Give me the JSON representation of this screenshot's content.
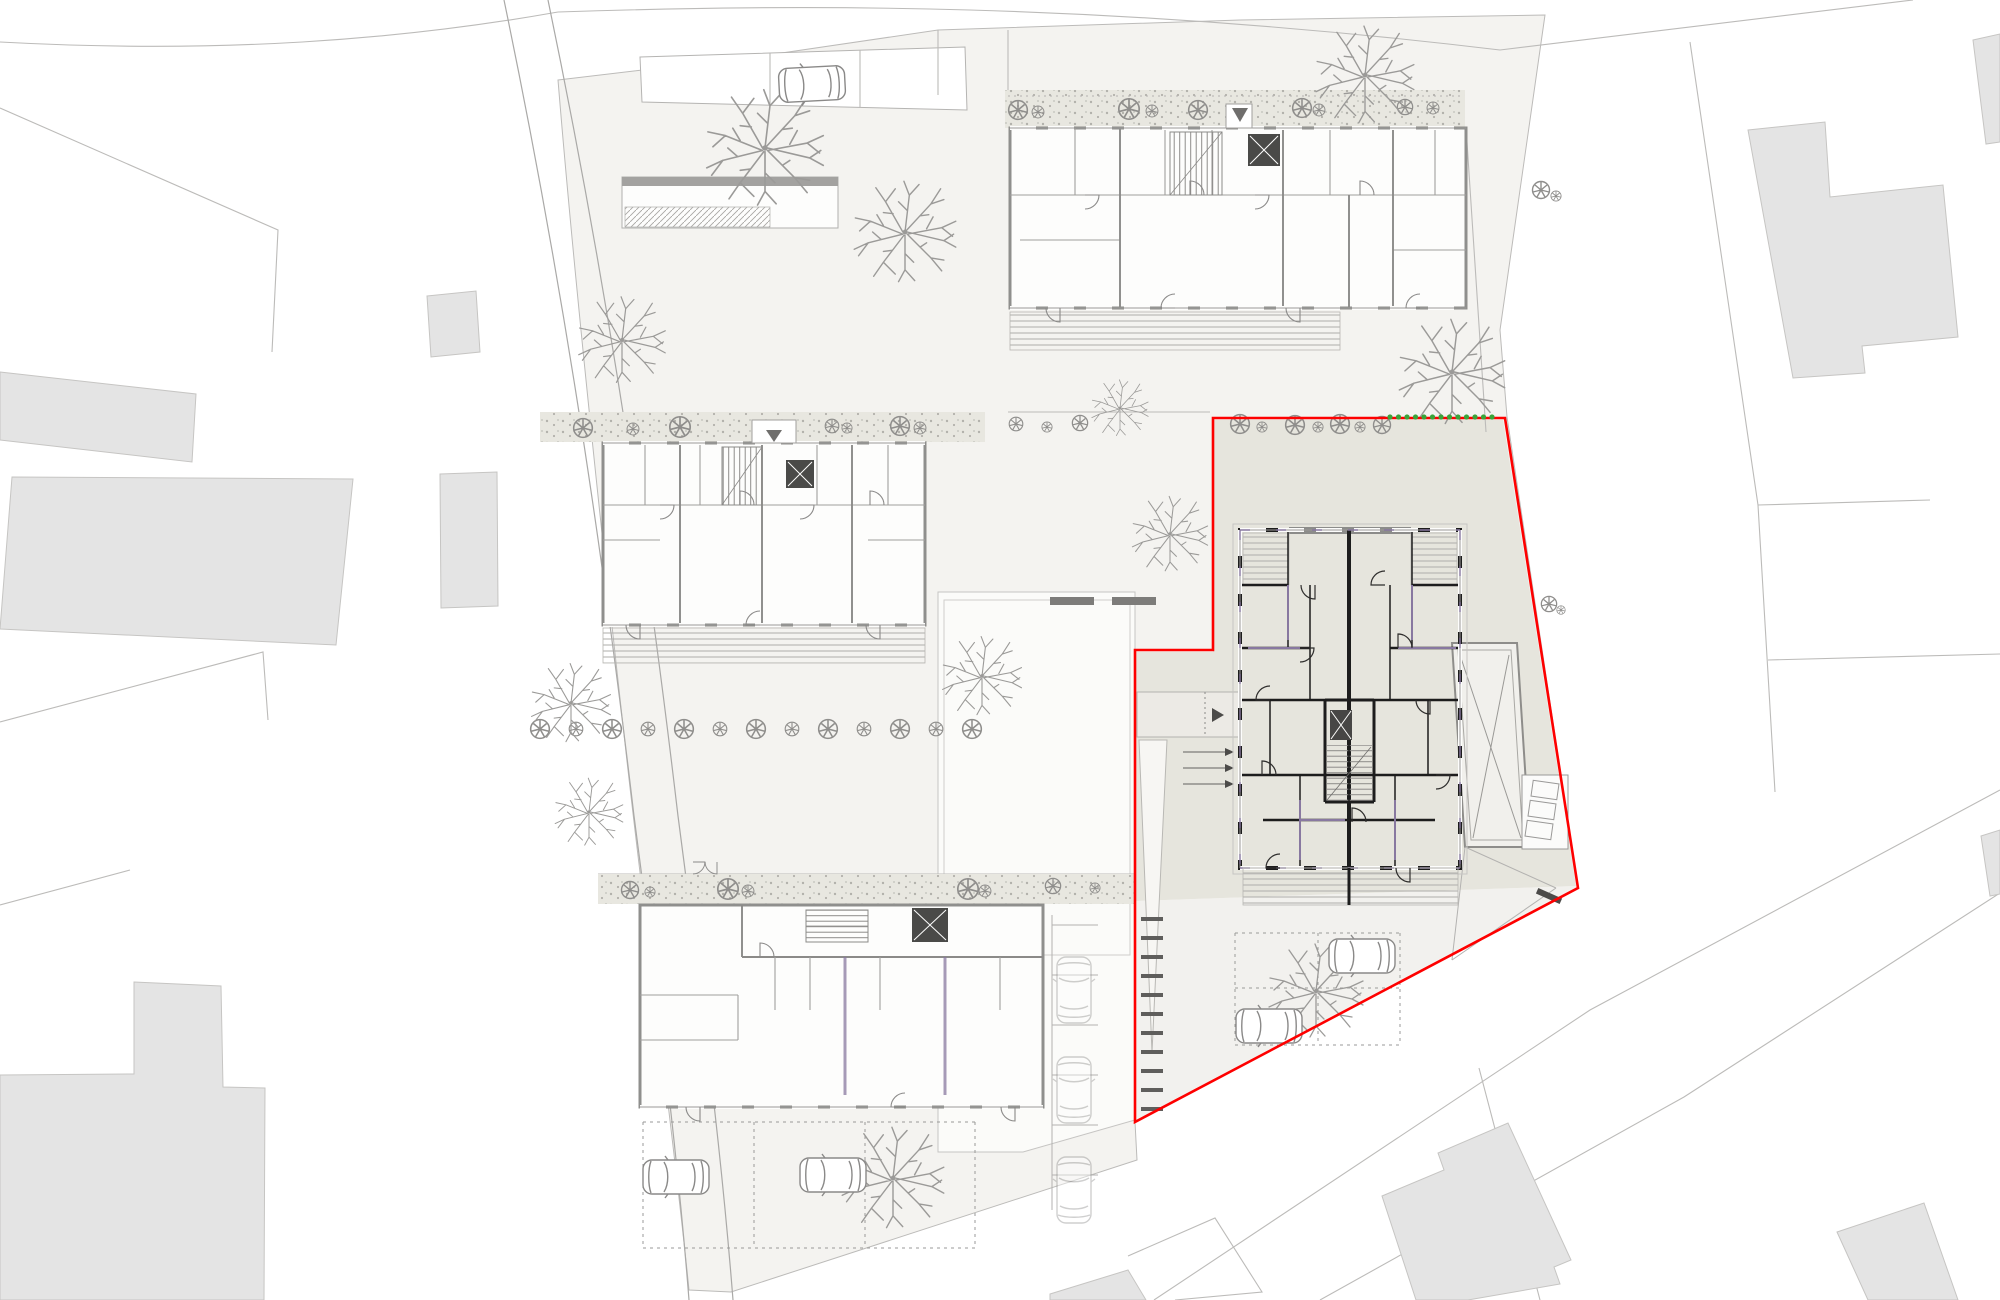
{
  "drawing": {
    "kind": "architectural-site-plan",
    "highlighted_parcel": "red-outlined lot with detailed apartment building",
    "visible_text": ""
  },
  "colors": {
    "background": "#ffffff",
    "site_fill": "#f4f3f0",
    "courtyard_fill": "#fbfbf9",
    "parcel_fill": "#e6e5dd",
    "parcel_outline": "#fe0000",
    "boundary_green": "#3aa43a",
    "neighbor_fill": "#e4e4e4",
    "parcel_line": "#bcbbb9",
    "road_line": "#aaa9a7",
    "wall_dark": "#1d1d1d",
    "wall_light": "#8f8f8d",
    "partition_purple": "#8878a0",
    "deck_line": "#aeadaa",
    "gravel_fill": "#e8e7e0",
    "gravel_dot": "#b2b1ab",
    "tree_stroke": "#9b9a98",
    "shrub_stroke": "#8f8e8c",
    "car_stroke": "#8a8988",
    "dash_dark": "#5f5e5c",
    "elevator_fill": "#474645"
  },
  "parcel": {
    "outline_points": "1213,418 1505,418 1578,888 1135,1122 1135,650 1213,650",
    "fill_points": "1213,420 1503,420 1576,886 1135,901 1135,652 1213,652",
    "parking_points": "1135,901 1576,886 1135,1120",
    "green_dashes": {
      "x0": 1390,
      "x1": 1500,
      "y": 417,
      "step": 8.5,
      "r": 2.6
    },
    "stall_dashes": {
      "x": 1152,
      "y0": 917,
      "step": 19,
      "count": 11,
      "len": 22,
      "w": 4
    }
  },
  "court": {
    "dashes": [
      [
        1050,
        597
      ],
      [
        1112,
        597
      ]
    ],
    "dash_w": 44,
    "dash_h": 8
  },
  "landscape": {
    "trees": [
      [
        765,
        148,
        62
      ],
      [
        905,
        232,
        54
      ],
      [
        622,
        340,
        46
      ],
      [
        1365,
        75,
        52
      ],
      [
        1452,
        372,
        56
      ],
      [
        1170,
        534,
        40
      ],
      [
        982,
        676,
        42
      ],
      [
        571,
        703,
        42
      ],
      [
        589,
        812,
        36
      ],
      [
        893,
        1178,
        54
      ],
      [
        1316,
        991,
        50
      ],
      [
        1120,
        408,
        30
      ]
    ],
    "shrubs": [
      [
        1018,
        110,
        11
      ],
      [
        1038,
        112,
        7
      ],
      [
        1129,
        109,
        12
      ],
      [
        1152,
        111,
        7
      ],
      [
        1198,
        110,
        11
      ],
      [
        1302,
        108,
        11
      ],
      [
        1319,
        110,
        7
      ],
      [
        1405,
        107,
        9
      ],
      [
        1433,
        108,
        7
      ],
      [
        583,
        428,
        11
      ],
      [
        633,
        429,
        7
      ],
      [
        680,
        427,
        12
      ],
      [
        832,
        426,
        8
      ],
      [
        847,
        428,
        6
      ],
      [
        900,
        426,
        11
      ],
      [
        920,
        428,
        7
      ],
      [
        630,
        890,
        10
      ],
      [
        650,
        892,
        6
      ],
      [
        728,
        889,
        12
      ],
      [
        748,
        891,
        7
      ],
      [
        968,
        889,
        12
      ],
      [
        985,
        891,
        7
      ],
      [
        1053,
        886,
        9
      ],
      [
        1095,
        888,
        6
      ],
      [
        540,
        729,
        11
      ],
      [
        576,
        729,
        8
      ],
      [
        612,
        729,
        11
      ],
      [
        648,
        729,
        8
      ],
      [
        684,
        729,
        11
      ],
      [
        720,
        729,
        8
      ],
      [
        756,
        729,
        11
      ],
      [
        792,
        729,
        8
      ],
      [
        828,
        729,
        11
      ],
      [
        864,
        729,
        8
      ],
      [
        900,
        729,
        11
      ],
      [
        936,
        729,
        8
      ],
      [
        972,
        729,
        11
      ],
      [
        1240,
        424,
        11
      ],
      [
        1262,
        427,
        6
      ],
      [
        1295,
        425,
        11
      ],
      [
        1318,
        427,
        6
      ],
      [
        1340,
        424,
        11
      ],
      [
        1360,
        427,
        6
      ],
      [
        1382,
        425,
        10
      ],
      [
        1016,
        424,
        8
      ],
      [
        1047,
        427,
        6
      ],
      [
        1080,
        423,
        9
      ],
      [
        1541,
        190,
        10
      ],
      [
        1556,
        196,
        6
      ],
      [
        1549,
        604,
        9
      ],
      [
        1561,
        610,
        5
      ]
    ]
  },
  "vehicles": {
    "cars": [
      [
        812,
        84,
        -3,
        0
      ],
      [
        676,
        1177,
        0,
        0
      ],
      [
        833,
        1175,
        0,
        0
      ],
      [
        1362,
        956,
        0,
        0
      ],
      [
        1269,
        1026,
        0,
        0
      ],
      [
        1074,
        990,
        90,
        1
      ],
      [
        1074,
        1090,
        90,
        1
      ],
      [
        1074,
        1190,
        90,
        1
      ]
    ]
  }
}
